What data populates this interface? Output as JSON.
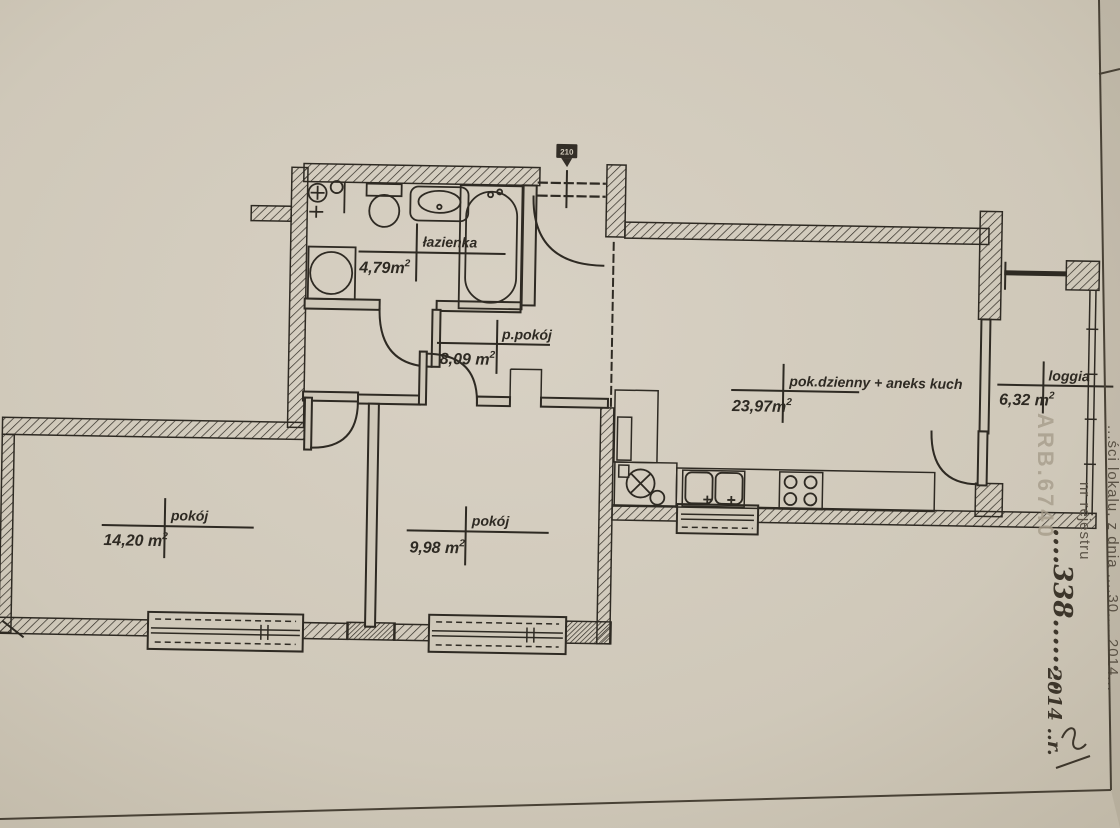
{
  "colors": {
    "paper": "#cfc8b9",
    "ink": "#2e2a23",
    "stamp": "#5b5347",
    "watermark": "#a79d8b",
    "hand": "#3d362b"
  },
  "rooms": [
    {
      "name": "łazienka",
      "area": "4,79m",
      "area_sup": "2"
    },
    {
      "name": "p.pokój",
      "area": "8,09 m",
      "area_sup": "2"
    },
    {
      "name": "pok.dzienny + aneks kuch",
      "area": "23,97m",
      "area_sup": "2"
    },
    {
      "name": "loggia",
      "area": "6,32 m",
      "area_sup": "2"
    },
    {
      "name": "pokój",
      "area": "14,20 m",
      "area_sup": "2"
    },
    {
      "name": "pokój",
      "area": "9,98 m",
      "area_sup": "2"
    }
  ],
  "annotations": {
    "door_height_marker": "210",
    "watermark": "ARB.6740",
    "stamp_line1": "...ści lokalu, z dnia ....30.....2014...",
    "stamp_line2": "nr rejestru",
    "handwritten_number": "....338........",
    "handwritten_year": "2014 ..r."
  }
}
